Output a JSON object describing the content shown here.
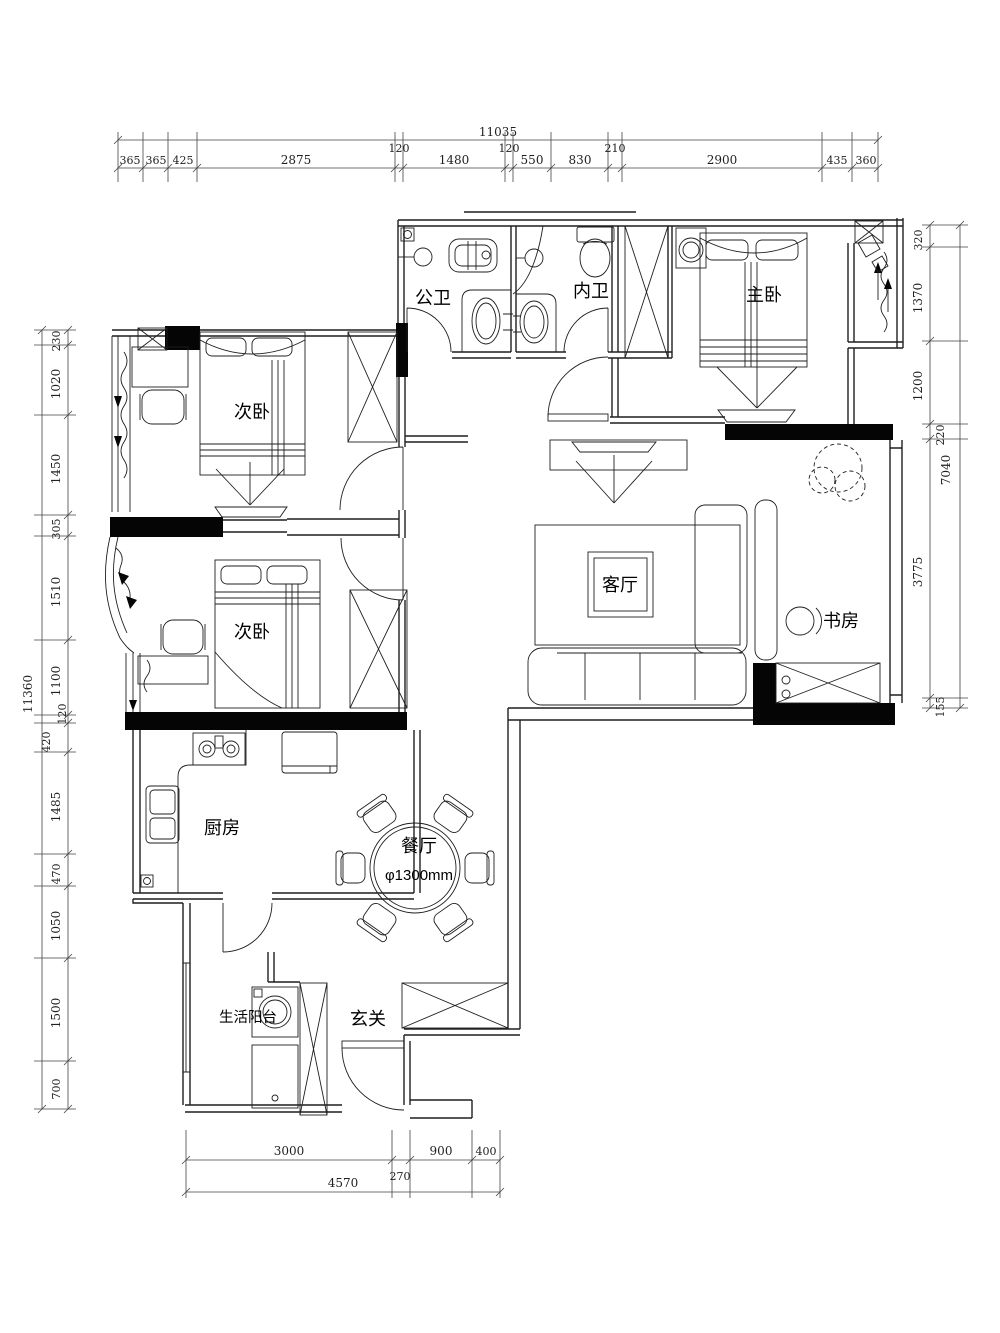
{
  "rooms": {
    "public_bath": "公卫",
    "ensuite_bath": "内卫",
    "master_bedroom": "主卧",
    "bedroom_upper": "次卧",
    "bedroom_lower": "次卧",
    "living_room": "客厅",
    "study": "书房",
    "kitchen": "厨房",
    "dining_room": "餐厅",
    "dining_table_diameter": "φ1300mm",
    "service_balcony": "生活阳台",
    "entry": "玄关"
  },
  "dimensions": {
    "top": {
      "total": "11035",
      "segments": [
        "365",
        "365",
        "425",
        "2875",
        "120",
        "1480",
        "120",
        "550",
        "830",
        "210",
        "2900",
        "435",
        "360"
      ]
    },
    "left": {
      "total": "11360",
      "segments": [
        "230",
        "1020",
        "1450",
        "305",
        "1510",
        "1100",
        "120",
        "420",
        "1485",
        "470",
        "1050",
        "1500",
        "700"
      ]
    },
    "right": {
      "total": "7040",
      "segments": [
        "320",
        "1370",
        "1200",
        "220",
        "3775",
        "155"
      ]
    },
    "bottom": {
      "total": "4570",
      "segments": [
        "3000",
        "270",
        "900",
        "400"
      ]
    }
  },
  "colors": {
    "line": "#1f1f1f",
    "dim": "#444444",
    "background": "#ffffff"
  }
}
